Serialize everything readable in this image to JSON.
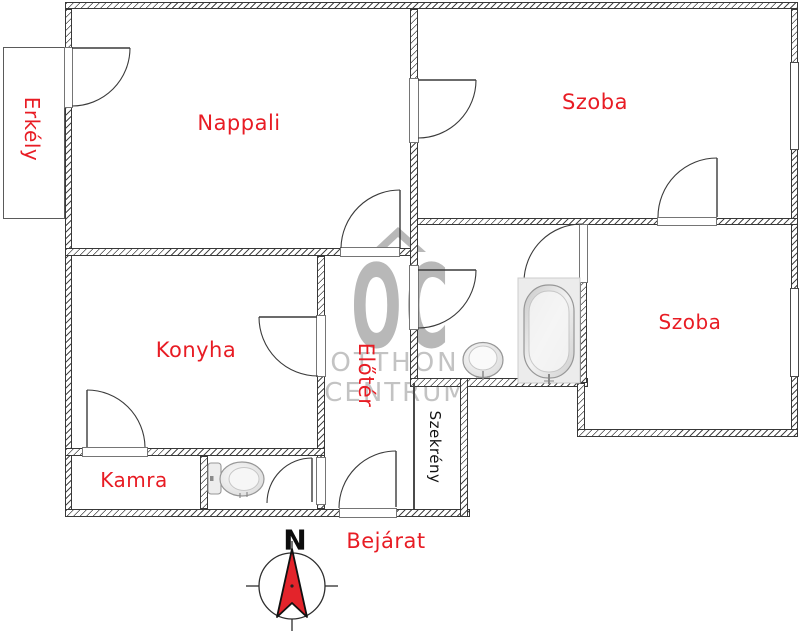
{
  "floorplan": {
    "labels": {
      "nappali": "Nappali",
      "szoba_top": "Szoba",
      "szoba_right": "Szoba",
      "konyha": "Konyha",
      "kamra": "Kamra",
      "erkely": "Erkély",
      "eloter": "Előtér",
      "szekreny": "Szekrény",
      "bejarat": "Bejárat"
    },
    "compass": {
      "north": "N"
    },
    "watermark": {
      "initials": "OC",
      "line1": "OTTHON",
      "line2": "CENTRUM"
    },
    "colors": {
      "label_red": "#e81c24",
      "wall_line": "#3d3d3d",
      "watermark_gray": "#b8b8b8",
      "compass_red": "#e3242b"
    }
  }
}
